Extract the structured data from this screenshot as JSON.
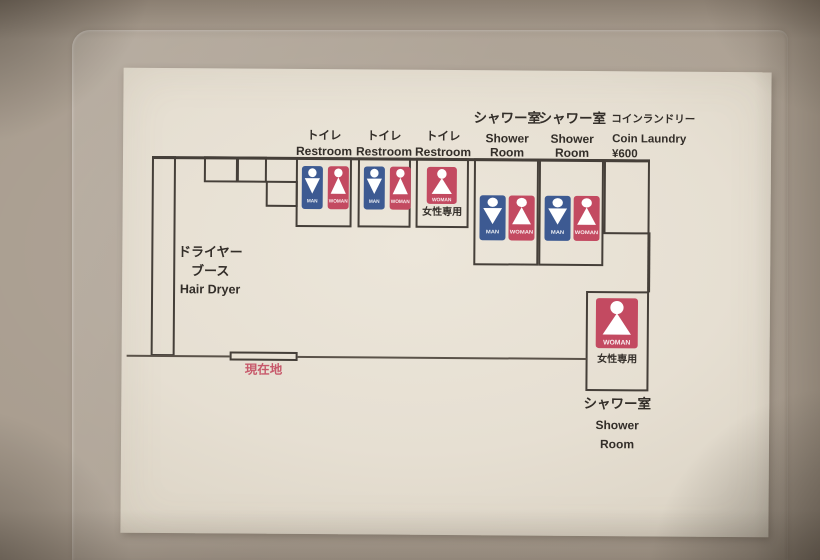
{
  "colors": {
    "wall_background": "#a89c8e",
    "paper": "#e8e1d4",
    "plan_line": "#453f39",
    "man_blue": "#3d5a92",
    "woman_red": "#c34a61",
    "location_pink": "#c7596b"
  },
  "labels": {
    "restroom_jp": "トイレ",
    "restroom_en": "Restroom",
    "shower_jp": "シャワー室",
    "shower_en1": "Shower",
    "shower_en2": "Room",
    "laundry_jp": "コインランドリー",
    "laundry_en": "Coin Laundry",
    "laundry_price": "¥600",
    "dryer_jp1": "ドライヤー",
    "dryer_jp2": "ブース",
    "dryer_en": "Hair Dryer",
    "current_location": "現在地",
    "women_only": "女性専用",
    "icon_man": "MAN",
    "icon_woman": "WOMAN"
  }
}
